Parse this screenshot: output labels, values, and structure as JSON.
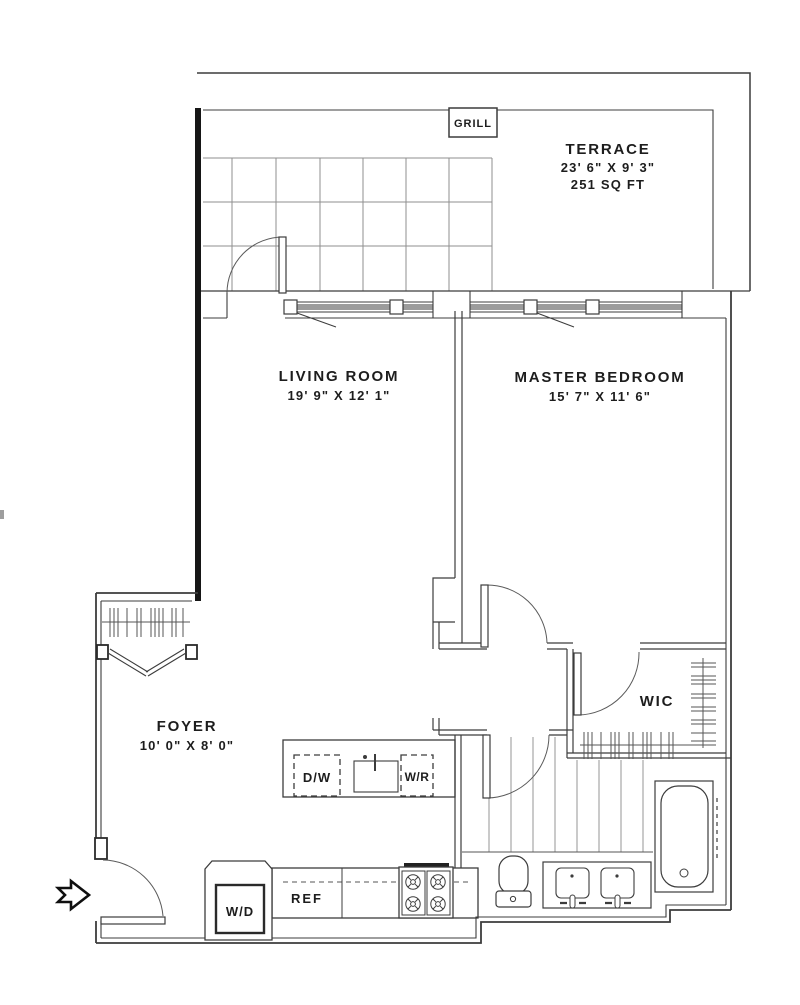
{
  "plan": {
    "terrace": {
      "name": "TERRACE",
      "dims": "23' 6\" X 9' 3\"",
      "area": "251 SQ FT",
      "grill": "GRILL"
    },
    "living_room": {
      "name": "LIVING ROOM",
      "dims": "19' 9\" X 12' 1\""
    },
    "master_bedroom": {
      "name": "MASTER BEDROOM",
      "dims": "15' 7\" X 11' 6\""
    },
    "foyer": {
      "name": "FOYER",
      "dims": "10' 0\" X 8' 0\""
    },
    "wic": {
      "name": "WIC"
    },
    "kitchen": {
      "dishwasher": "D/W",
      "wine_ref": "W/R",
      "refrigerator": "REF",
      "washer_dryer": "W/D"
    },
    "colors": {
      "line": "#3c3c3c",
      "heavy_wall": "#161616",
      "glass": "#9c9c9c",
      "grid": "#8f8f8f",
      "text": "#1d1d1d"
    }
  }
}
